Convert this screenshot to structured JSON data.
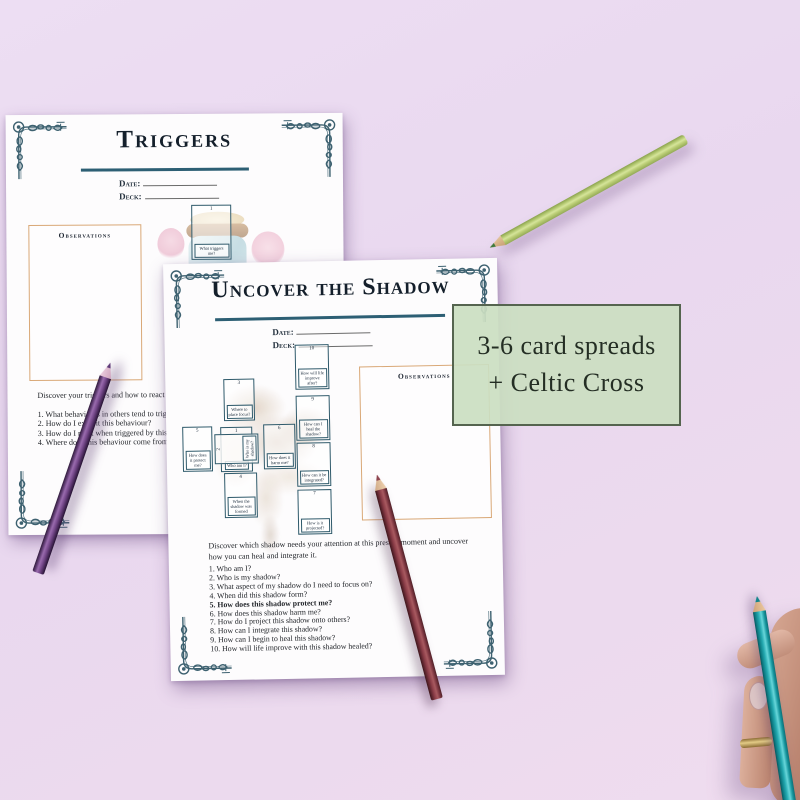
{
  "pages": {
    "triggers": {
      "title": "Triggers",
      "date_label": "Date:",
      "deck_label": "Deck:",
      "observations_label": "Observations",
      "card": {
        "number": "1",
        "label": "What triggers me?"
      },
      "intro": "Discover your triggers and how to react in a healthy way.",
      "questions": [
        "1. What behaviours in others tend to trigger me?",
        "2. How do I exhibit this behaviour?",
        "3. How do I react when triggered by this behaviour?",
        "4. Where does this behaviour come from?"
      ]
    },
    "shadow": {
      "title": "Uncover the Shadow",
      "date_label": "Date:",
      "deck_label": "Deck:",
      "observations_label": "Observations",
      "intro": "Discover which shadow needs your attention at this present moment and uncover how you can heal and integrate it.",
      "questions": [
        "1. Who am I?",
        "2. Who is my shadow?",
        "3. What aspect of my shadow do I need to focus on?",
        "4. When did this shadow form?",
        "5. How does this shadow protect me?",
        "6. How does this shadow harm me?",
        "7. How do I project this shadow onto others?",
        "8. How can I integrate this shadow?",
        "9. How can I begin to heal this shadow?",
        "10. How will life improve with this shadow healed?"
      ],
      "spread": {
        "cards": [
          {
            "pos": "above",
            "number": "3",
            "label": "Where to place focus?"
          },
          {
            "pos": "left",
            "number": "5",
            "label": "How does it protect me?"
          },
          {
            "pos": "center",
            "number": "1",
            "label": "Who am I?"
          },
          {
            "pos": "crossing",
            "number": "2",
            "label": "Who is my shadow?"
          },
          {
            "pos": "right",
            "number": "6",
            "label": "How does it harm me?"
          },
          {
            "pos": "below",
            "number": "4",
            "label": "When the shadow was formed"
          },
          {
            "pos": "staff-1",
            "number": "10",
            "label": "How will life improve after?"
          },
          {
            "pos": "staff-2",
            "number": "9",
            "label": "How can I heal the shadow?"
          },
          {
            "pos": "staff-3",
            "number": "8",
            "label": "How can it be integrated?"
          },
          {
            "pos": "staff-4",
            "number": "7",
            "label": "How is it projected?"
          }
        ]
      }
    }
  },
  "badge": {
    "line1": "3-6 card spreads",
    "line2": "+ Celtic Cross"
  },
  "colors": {
    "background": "#e9d9ef",
    "badge_green": "#cbdfc3",
    "ornament_teal": "#3d6170",
    "underline_teal": "#2d5f74",
    "observations_border": "#d9a877",
    "pencil_purple": "#6e4180",
    "pencil_maroon": "#8e3f4a",
    "pencil_green": "#b9cc74",
    "pencil_teal": "#1aa3ab"
  }
}
